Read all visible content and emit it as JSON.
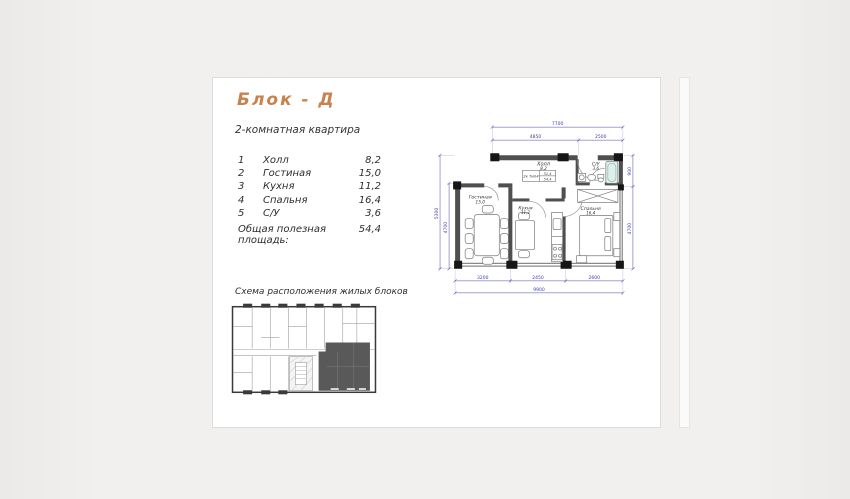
{
  "page": {
    "title": "Блок - Д",
    "subtitle": "2-комнатная квартира",
    "rooms": [
      {
        "num": "1",
        "name": "Холл",
        "area": "8,2"
      },
      {
        "num": "2",
        "name": "Гостиная",
        "area": "15,0"
      },
      {
        "num": "3",
        "name": "Кухня",
        "area": "11,2"
      },
      {
        "num": "4",
        "name": "Спальня",
        "area": "16,4"
      },
      {
        "num": "5",
        "name": "С/У",
        "area": "3,6"
      }
    ],
    "total_label": "Общая полезная площадь:",
    "total_value": "54,4",
    "scheme_caption": "Схема расположения жилых блоков"
  },
  "floorplan": {
    "rooms": {
      "hall": {
        "name": "Холл",
        "area": "8,2"
      },
      "living": {
        "name": "Гостиная",
        "area": "15,0"
      },
      "kitchen": {
        "name": "Кухня",
        "area": "11,2"
      },
      "bedroom": {
        "name": "Спальня",
        "area": "16,4"
      },
      "bath": {
        "name": "С/У",
        "area": "3,6"
      }
    },
    "stamp": {
      "type": "2к Тип4",
      "living_area": "31,4",
      "total_area": "54,4"
    },
    "dims": {
      "top_total": "7700",
      "top_left": "4850",
      "top_right": "2500",
      "left_outer": "5300",
      "left_inner": "4700",
      "right_top": "900",
      "right_bottom": "4700",
      "bottom_1": "3200",
      "bottom_2": "2450",
      "bottom_3": "2600",
      "bottom_total": "9900"
    }
  },
  "colors": {
    "accent_title": "#c9824d",
    "dimension_blue": "#4040a8",
    "wall_gray": "#4f4f4f",
    "corner_black": "#161616",
    "highlight_block": "#595959",
    "page_bg": "#ffffff",
    "desktop_bg": "#f1f0ee"
  }
}
